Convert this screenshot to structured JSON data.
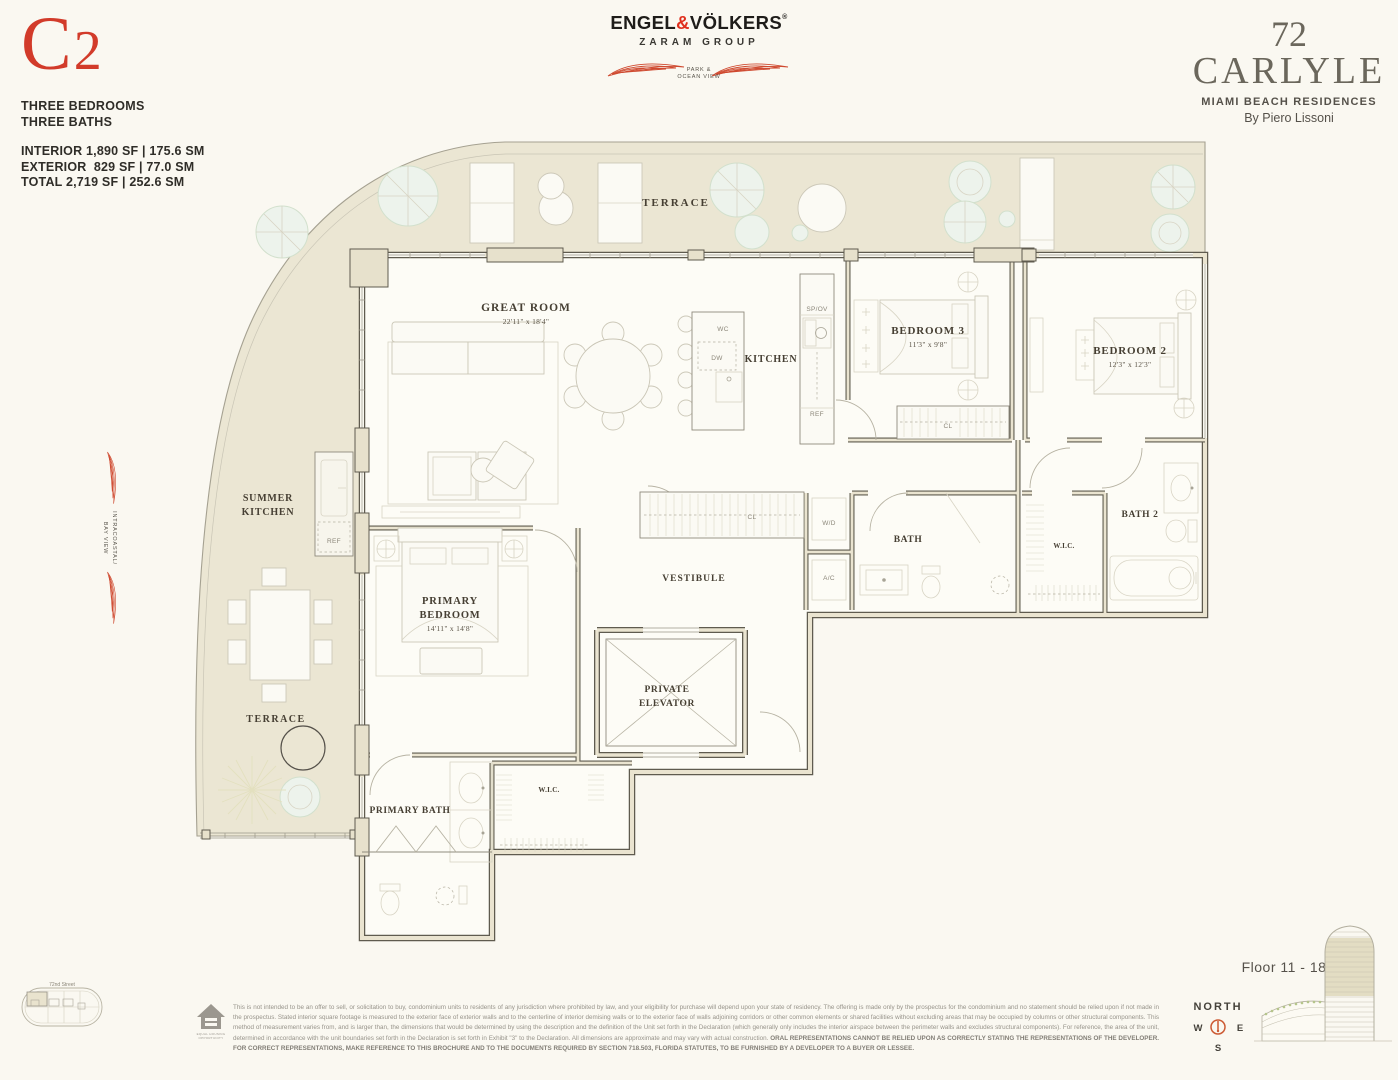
{
  "unit": {
    "code_letter": "C",
    "code_digit": "2",
    "line1": "THREE BEDROOMS",
    "line2": "THREE BATHS",
    "interior": "INTERIOR 1,890 SF | 175.6 SM",
    "exterior": "EXTERIOR  829 SF | 77.0 SM",
    "total": "TOTAL 2,719 SF | 252.6 SM"
  },
  "broker": {
    "name_pre": "ENGEL",
    "amp": "&",
    "name_post": "VÖLKERS",
    "reg": "®",
    "group": "ZARAM GROUP"
  },
  "project": {
    "number": "72",
    "name": "CARLYLE",
    "tagline": "MIAMI BEACH RESIDENCES",
    "byline": "By Piero Lissoni"
  },
  "views": {
    "top_1": "PARK &",
    "top_2": "OCEAN VIEW",
    "left_1": "INTRACOASTAL/",
    "left_2": "BAY VIEW"
  },
  "rooms": {
    "terrace_top": "TERRACE",
    "great_room": "GREAT ROOM",
    "great_room_dims": "22'11\" x 18'4\"",
    "kitchen": "KITCHEN",
    "bedroom3": "BEDROOM 3",
    "bedroom3_dims": "11'3\" x 9'8\"",
    "bedroom2": "BEDROOM 2",
    "bedroom2_dims": "12'3\" x 12'3\"",
    "summer_kitchen_1": "SUMMER",
    "summer_kitchen_2": "KITCHEN",
    "primary_1": "PRIMARY",
    "primary_2": "BEDROOM",
    "primary_dims": "14'11\" x 14'8\"",
    "vestibule": "VESTIBULE",
    "elevator_1": "PRIVATE",
    "elevator_2": "ELEVATOR",
    "bath": "BATH",
    "bath2": "BATH 2",
    "wic_right": "W.I.C.",
    "wic_bottom": "W.I.C.",
    "primary_bath": "PRIMARY BATH",
    "terrace_bottom": "TERRACE"
  },
  "fixtures": {
    "wc": "WC",
    "dw": "DW",
    "spov": "SP/OV",
    "ref_kitchen": "REF",
    "ref_summer": "REF",
    "wd": "W/D",
    "ac": "A/C",
    "cl_bed3": "CL",
    "cl_entry": "CL"
  },
  "keyplan": {
    "street": "72nd Street"
  },
  "tower": {
    "floors": "Floor 11 - 18"
  },
  "compass": {
    "label": "NORTH",
    "w": "W",
    "e": "E",
    "s": "S"
  },
  "eho": {
    "line1": "EQUAL HOUSING",
    "line2": "OPPORTUNITY"
  },
  "legal": {
    "text": "This is not intended to be an offer to sell, or solicitation to buy, condominium units to residents of any jurisdiction where prohibited by law, and your eligibility for purchase will depend upon your state of residency. The offering is made only by the prospectus for the condominium and no statement should be relied upon if not made in the prospectus. Stated interior square footage is measured to the exterior face of exterior walls and to the centerline of interior demising walls or to the exterior face of walls adjoining corridors or other common elements or shared facilities without excluding areas that may be occupied by columns or other structural components. This method of measurement varies from, and is larger than, the dimensions that would be determined by using the description and the definition of the Unit set forth in the Declaration (which generally only includes the interior airspace between the perimeter walls and excludes structural components). For reference, the area of the unit, determined in accordance with the unit boundaries set forth in the Declaration is set forth in Exhibit \"3\" to the Declaration. All dimensions are approximate and may vary with actual construction.",
    "bold": "ORAL REPRESENTATIONS CANNOT BE RELIED UPON AS CORRECTLY STATING THE REPRESENTATIONS OF THE DEVELOPER. FOR CORRECT REPRESENTATIONS, MAKE REFERENCE TO THIS BROCHURE AND TO THE DOCUMENTS REQUIRED BY SECTION 718.503, FLORIDA STATUTES, TO BE FURNISHED BY A DEVELOPER TO A BUYER OR LESSEE."
  },
  "colors": {
    "accent_red": "#d23b2a",
    "terrace_fill": "#ebe6d3",
    "wall": "#5f5b4f",
    "wall_fill": "#e7e1cc"
  }
}
